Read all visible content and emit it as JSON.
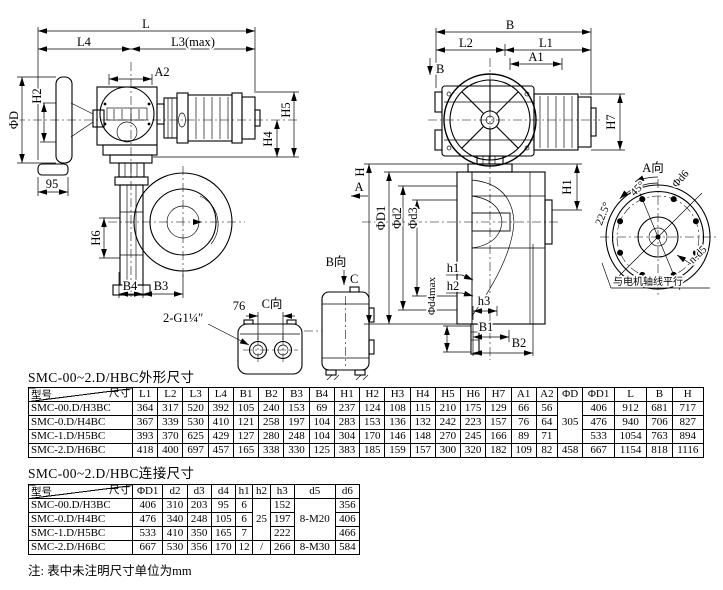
{
  "drawing_left": {
    "labels": {
      "L": "L",
      "L4": "L4",
      "L3max": "L3(max)",
      "A2": "A2",
      "H5": "H5",
      "H4": "H4",
      "phiD": "ΦD",
      "H2": "H2",
      "d95": "95",
      "H6": "H6",
      "B4": "B4",
      "B3": "B3",
      "thread": "2-G1¼″"
    }
  },
  "drawing_right": {
    "labels": {
      "B": "B",
      "L2": "L2",
      "L1": "L1",
      "A1": "A1",
      "viewB": "B",
      "viewA": "A",
      "H7": "H7",
      "H1": "H1",
      "H": "H",
      "phiD1": "ΦD1",
      "phid2": "Φd2",
      "phid3": "Φd3",
      "phid4max": "Φd4max",
      "h1": "h1",
      "h2": "h2",
      "h3": "h3",
      "B1": "B1",
      "B2": "B2"
    }
  },
  "view_A": {
    "title": "A向",
    "phid6": "Φd6",
    "deg45": "45°",
    "deg225": "22.5°",
    "nd5": "n-d5",
    "note": "与电机轴线平行"
  },
  "view_B": {
    "title": "B向",
    "arrow": "C"
  },
  "view_C": {
    "title": "C向",
    "d76": "76"
  },
  "table1": {
    "title": "SMC-00~2.D/HBC外形尺寸",
    "corner": {
      "model": "型号",
      "size": "尺寸"
    },
    "headers": [
      "L1",
      "L2",
      "L3",
      "L4",
      "B1",
      "B2",
      "B3",
      "B4",
      "H1",
      "H2",
      "H3",
      "H4",
      "H5",
      "H6",
      "H7",
      "A1",
      "A2",
      "ΦD",
      "ΦD1",
      "L",
      "B",
      "H"
    ],
    "rows": [
      {
        "model": "SMC-00.D/H3BC",
        "cells": [
          364,
          317,
          520,
          392,
          105,
          240,
          153,
          69,
          237,
          124,
          108,
          115,
          210,
          175,
          129,
          66,
          56,
          {
            "v": "305",
            "rs": 3
          },
          406,
          912,
          681,
          717
        ]
      },
      {
        "model": "SMC-0.D/H4BC",
        "cells": [
          367,
          339,
          530,
          410,
          121,
          258,
          197,
          104,
          283,
          153,
          136,
          132,
          242,
          223,
          157,
          76,
          64,
          null,
          476,
          940,
          706,
          827
        ]
      },
      {
        "model": "SMC-1.D/H5BC",
        "cells": [
          393,
          370,
          625,
          429,
          127,
          280,
          248,
          104,
          304,
          170,
          146,
          148,
          270,
          245,
          166,
          89,
          71,
          null,
          533,
          1054,
          763,
          894
        ]
      },
      {
        "model": "SMC-2.D/H6BC",
        "cells": [
          418,
          400,
          697,
          457,
          165,
          338,
          330,
          125,
          383,
          185,
          159,
          157,
          300,
          320,
          182,
          109,
          82,
          458,
          667,
          1154,
          818,
          1116
        ]
      }
    ]
  },
  "table2": {
    "title": "SMC-00~2.D/HBC连接尺寸",
    "corner": {
      "model": "型号",
      "size": "尺寸"
    },
    "headers": [
      "ΦD1",
      "d2",
      "d3",
      "d4",
      "h1",
      "h2",
      "h3",
      "d5",
      "d6"
    ],
    "rows": [
      {
        "model": "SMC-00.D/H3BC",
        "cells": [
          406,
          310,
          203,
          95,
          6,
          {
            "v": "25",
            "rs": 3
          },
          152,
          {
            "v": "8-M20",
            "rs": 3
          },
          356
        ]
      },
      {
        "model": "SMC-0.D/H4BC",
        "cells": [
          476,
          340,
          248,
          105,
          6,
          null,
          197,
          null,
          406
        ]
      },
      {
        "model": "SMC-1.D/H5BC",
        "cells": [
          533,
          410,
          350,
          165,
          7,
          null,
          222,
          null,
          466
        ]
      },
      {
        "model": "SMC-2.D/H6BC",
        "cells": [
          667,
          530,
          356,
          170,
          12,
          "/",
          266,
          "8-M30",
          584
        ]
      }
    ]
  },
  "footnote": "注: 表中未注明尺寸单位为mm"
}
